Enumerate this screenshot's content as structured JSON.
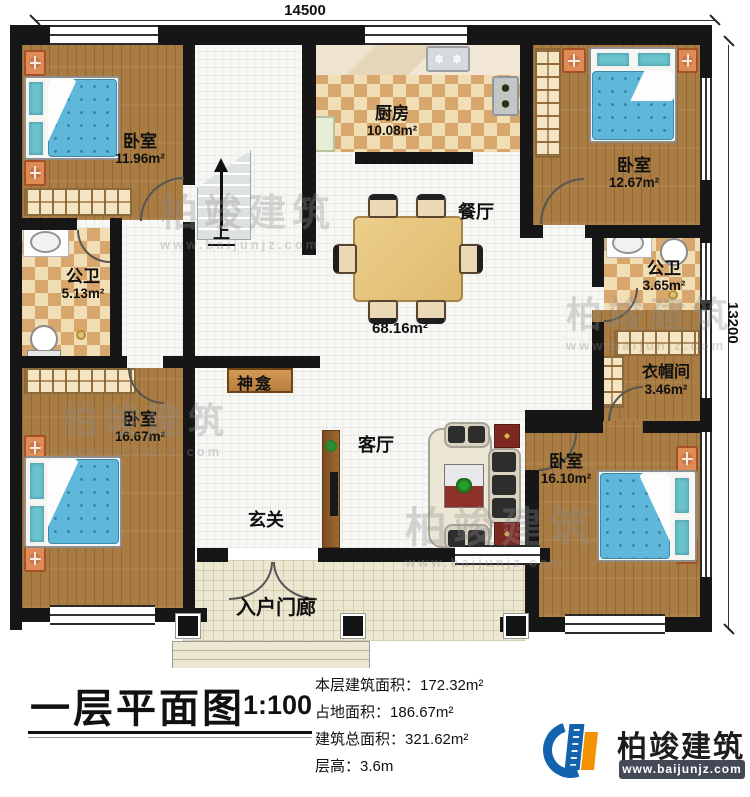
{
  "dimensions": {
    "width_mm": "14500",
    "height_mm": "13200"
  },
  "rooms": {
    "bedroom_tl": {
      "label": "卧室",
      "area": "11.96m²"
    },
    "kitchen": {
      "label": "厨房",
      "area": "10.08m²"
    },
    "bedroom_tr": {
      "label": "卧室",
      "area": "12.67m²"
    },
    "bath_left": {
      "label": "公卫",
      "area": "5.13m²"
    },
    "bath_right": {
      "label": "公卫",
      "area": "3.65m²"
    },
    "cloakroom": {
      "label": "衣帽间",
      "area": "3.46m²"
    },
    "bedroom_bl": {
      "label": "卧室",
      "area": "16.67m²"
    },
    "bedroom_br": {
      "label": "卧室",
      "area": "16.10m²"
    }
  },
  "labels": {
    "dining": "餐厅",
    "living": "客厅",
    "foyer": "玄关",
    "porch": "入户门廊",
    "shrine": "神龛",
    "up": "上",
    "hall_area": "68.16m²"
  },
  "title_block": {
    "title": "一层平面图",
    "scale": "1:100"
  },
  "stats": {
    "items": [
      {
        "label": "本层建筑面积：",
        "value": "172.32m²"
      },
      {
        "label": "占地面积：",
        "value": "186.67m²"
      },
      {
        "label": "建筑总面积：",
        "value": "321.62m²"
      },
      {
        "label": "层高：",
        "value": "3.6m"
      }
    ]
  },
  "logo": {
    "name": "柏竣建筑",
    "url": "www.baijunjz.com"
  },
  "watermark": {
    "text": "柏竣建筑",
    "url": "www.baijunjz.com"
  },
  "colors": {
    "wall": "#161616",
    "wood": "#a87c42",
    "checker": "#d8a76d",
    "bed_blue": "#5fb7d9",
    "brand_blue": "#1262ae",
    "brand_orange": "#f39200"
  }
}
